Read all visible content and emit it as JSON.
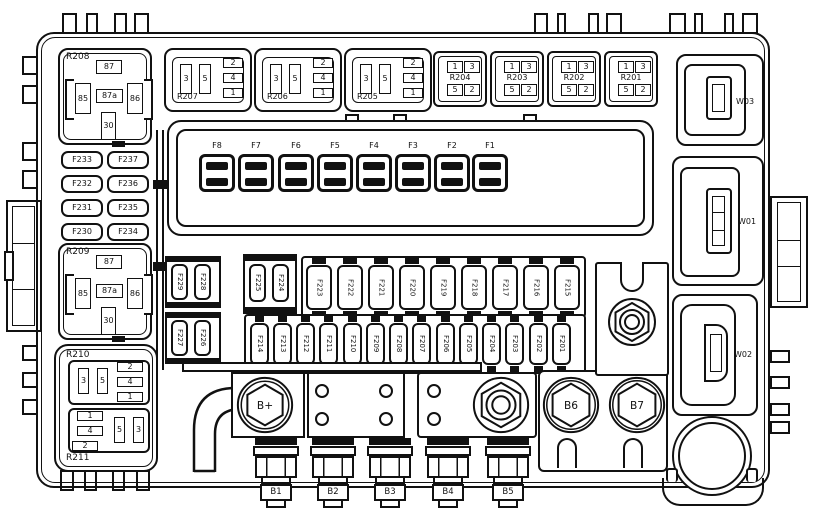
{
  "colors": {
    "line": "#111111",
    "background": "#ffffff"
  },
  "relays": {
    "R208": {
      "label": "R208",
      "p87": "87",
      "p85": "85",
      "p87a": "87a",
      "p86": "86",
      "p30": "30"
    },
    "R209": {
      "label": "R209",
      "p87": "87",
      "p85": "85",
      "p87a": "87a",
      "p86": "86",
      "p30": "30"
    },
    "R207": {
      "label": "R207",
      "p2": "2",
      "p4": "4",
      "p1": "1",
      "p3": "3",
      "p5": "5"
    },
    "R206": {
      "label": "R206",
      "p2": "2",
      "p4": "4",
      "p1": "1",
      "p3": "3",
      "p5": "5"
    },
    "R205": {
      "label": "R205",
      "p2": "2",
      "p4": "4",
      "p1": "1",
      "p3": "3",
      "p5": "5"
    },
    "R204": {
      "label": "R204",
      "p1": "1",
      "p3": "3",
      "p5": "5",
      "p2": "2"
    },
    "R203": {
      "label": "R203",
      "p1": "1",
      "p3": "3",
      "p5": "5",
      "p2": "2"
    },
    "R202": {
      "label": "R202",
      "p1": "1",
      "p3": "3",
      "p5": "5",
      "p2": "2"
    },
    "R201": {
      "label": "R201",
      "p1": "1",
      "p3": "3",
      "p5": "5",
      "p2": "2"
    },
    "R210": {
      "label": "R210",
      "p3": "3",
      "p5": "5",
      "p2": "2",
      "p4": "4",
      "p1": "1"
    },
    "R211": {
      "label": "R211",
      "p1": "1",
      "p4": "4",
      "p2": "2",
      "p5": "5",
      "p3": "3"
    }
  },
  "maxi_fuses": [
    "F8",
    "F7",
    "F6",
    "F5",
    "F4",
    "F3",
    "F2",
    "F1"
  ],
  "left_fuse_grid": [
    "F233",
    "F237",
    "F232",
    "F236",
    "F231",
    "F235",
    "F230",
    "F234"
  ],
  "quad_fuses": [
    "F229",
    "F228",
    "F227",
    "F226"
  ],
  "pair_fuses": [
    "F225",
    "F224"
  ],
  "top_fuse_row": [
    "F223",
    "F222",
    "F221",
    "F220",
    "F219",
    "F218",
    "F217",
    "F216",
    "F215"
  ],
  "bottom_fuse_row": [
    "F214",
    "F213",
    "F212",
    "F211",
    "F210",
    "F209",
    "F208",
    "F207",
    "F206",
    "F205",
    "F204",
    "F203",
    "F202",
    "F201"
  ],
  "bolts": {
    "bplus": "B+",
    "b1": "B1",
    "b2": "B2",
    "b3": "B3",
    "b4": "B4",
    "b5": "B5",
    "b6": "B6",
    "b7": "B7"
  },
  "connectors": {
    "w01": "W01",
    "w02": "W02",
    "w03": "W03"
  }
}
